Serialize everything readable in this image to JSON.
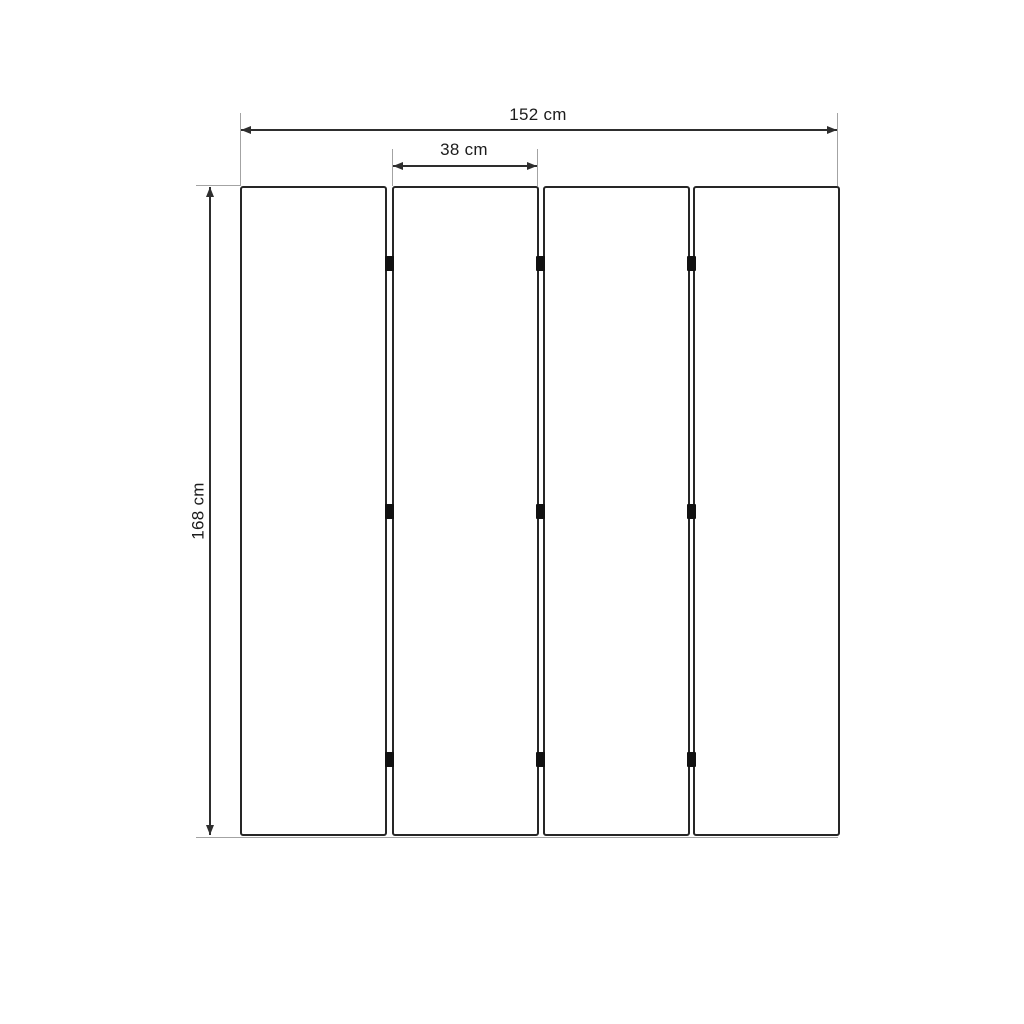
{
  "diagram": {
    "type": "product-dimension-diagram",
    "subject": "four-panel folding screen, front elevation"
  },
  "dimensions": {
    "total_width": {
      "label": "152 cm",
      "value_cm": 152,
      "orientation": "horizontal"
    },
    "panel_width": {
      "label": "38 cm",
      "value_cm": 38,
      "orientation": "horizontal"
    },
    "height": {
      "label": "168 cm",
      "value_cm": 168,
      "orientation": "vertical"
    }
  },
  "structure": {
    "panel_count": 4,
    "hinge_joints": 3,
    "hinges_per_joint": 3
  },
  "colors": {
    "background": "#ffffff",
    "panel_border": "#262626",
    "hinge": "#111111",
    "dimension_line": "#2e2e2e",
    "extension_line": "#a3a3a3",
    "text": "#1c1c1c"
  }
}
